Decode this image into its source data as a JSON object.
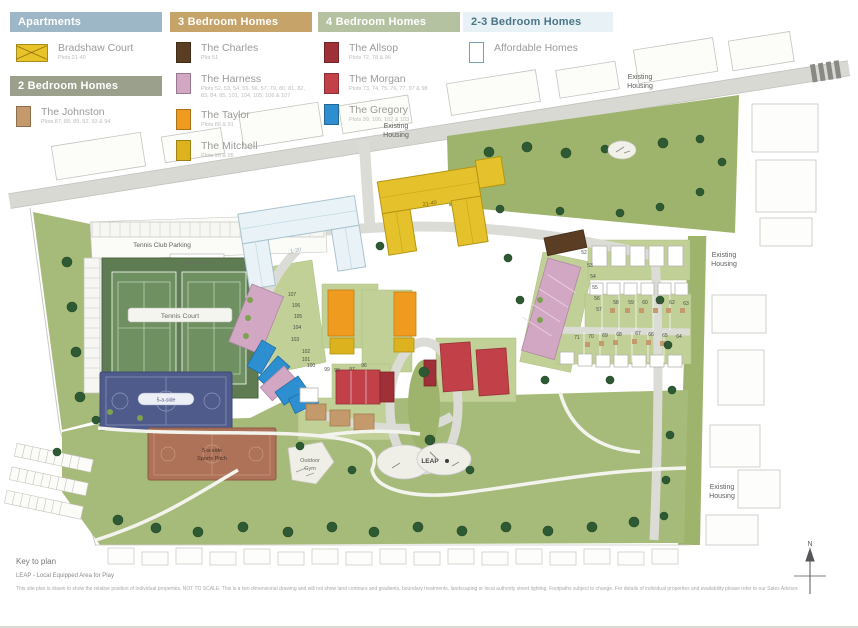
{
  "legend": {
    "apartments": {
      "header": "Apartments",
      "items": [
        {
          "name": "Bradshaw Court",
          "plots": "Plots 21-40",
          "color": "#e9c428"
        }
      ]
    },
    "two_bed": {
      "header": "2 Bedroom Homes",
      "items": [
        {
          "name": "The Johnston",
          "plots": "Plots 87, 88, 89, 92, 93 & 94",
          "color": "#c49a6c"
        }
      ]
    },
    "three_bed": {
      "header": "3 Bedroom Homes",
      "items": [
        {
          "name": "The Charles",
          "plots": "Plot 51",
          "color": "#5a3d22"
        },
        {
          "name": "The Harness",
          "plots": "Plots 52, 53, 54, 55, 56, 57, 79, 80, 81, 82, 83, 84, 85, 101, 104, 105, 106 & 107",
          "color": "#d2a7c3"
        },
        {
          "name": "The Taylor",
          "plots": "Plots 86 & 91",
          "color": "#ef9b20"
        },
        {
          "name": "The Mitchell",
          "plots": "Plots 90 & 95",
          "color": "#dcb31e"
        }
      ]
    },
    "four_bed": {
      "header": "4 Bedroom Homes",
      "items": [
        {
          "name": "The Allsop",
          "plots": "Plots 72, 78 & 96",
          "color": "#a03038"
        },
        {
          "name": "The Morgan",
          "plots": "Plots 73, 74, 75, 76, 77, 97 & 98",
          "color": "#c24048"
        },
        {
          "name": "The Gregory",
          "plots": "Plots 99, 100, 102 & 103",
          "color": "#2e8fd0"
        }
      ]
    },
    "two_three_bed": {
      "header": "2-3 Bedroom Homes",
      "items": [
        {
          "name": "Affordable Homes",
          "plots": "",
          "color": "#ffffff"
        }
      ]
    }
  },
  "map": {
    "labels": {
      "existing": "Existing",
      "housing": "Housing",
      "tennis_club_parking": "Tennis Club Parking",
      "spectator_area": "Spectator Area",
      "tennis_court": "Tennis Court",
      "five_a_side": "5-a-side",
      "pitch_line1": "5-a-side",
      "pitch_line2": "Sports Pitch",
      "outdoor": "Outdoor",
      "gym": "Gym",
      "leap": "LEAP",
      "apartments_1_20": "1-20",
      "apartments_21_40": "21-40",
      "north": "N"
    },
    "plot_numbers": [
      {
        "t": "51",
        "x": 582,
        "y": 243
      },
      {
        "t": "52",
        "x": 584,
        "y": 254
      },
      {
        "t": "53",
        "x": 590,
        "y": 267
      },
      {
        "t": "54",
        "x": 593,
        "y": 278
      },
      {
        "t": "55",
        "x": 595,
        "y": 289
      },
      {
        "t": "56",
        "x": 597,
        "y": 300
      },
      {
        "t": "57",
        "x": 599,
        "y": 311
      },
      {
        "t": "58",
        "x": 616,
        "y": 304
      },
      {
        "t": "59",
        "x": 631,
        "y": 304
      },
      {
        "t": "60",
        "x": 645,
        "y": 304
      },
      {
        "t": "61",
        "x": 659,
        "y": 304
      },
      {
        "t": "62",
        "x": 672,
        "y": 304
      },
      {
        "t": "63",
        "x": 686,
        "y": 305
      },
      {
        "t": "71",
        "x": 577,
        "y": 339
      },
      {
        "t": "70",
        "x": 591,
        "y": 338
      },
      {
        "t": "69",
        "x": 605,
        "y": 337
      },
      {
        "t": "68",
        "x": 619,
        "y": 336
      },
      {
        "t": "67",
        "x": 638,
        "y": 335
      },
      {
        "t": "66",
        "x": 651,
        "y": 336
      },
      {
        "t": "65",
        "x": 665,
        "y": 337
      },
      {
        "t": "64",
        "x": 679,
        "y": 338
      },
      {
        "t": "107",
        "x": 292,
        "y": 296
      },
      {
        "t": "106",
        "x": 296,
        "y": 307
      },
      {
        "t": "105",
        "x": 298,
        "y": 318
      },
      {
        "t": "104",
        "x": 297,
        "y": 329
      },
      {
        "t": "103",
        "x": 295,
        "y": 341
      },
      {
        "t": "102",
        "x": 306,
        "y": 353
      },
      {
        "t": "101",
        "x": 306,
        "y": 361
      },
      {
        "t": "100",
        "x": 311,
        "y": 367
      },
      {
        "t": "99",
        "x": 327,
        "y": 371
      },
      {
        "t": "98",
        "x": 337,
        "y": 372
      },
      {
        "t": "97",
        "x": 352,
        "y": 371
      },
      {
        "t": "96",
        "x": 364,
        "y": 367
      }
    ]
  },
  "footer": {
    "key_title": "Key to plan",
    "leap_note": "LEAP - Local Equipped Area for Play",
    "disclaimer": "This site plan is drawn to show the relative position of individual properties, NOT TO SCALE. This is a two dimensional drawing and will not show land contours and gradients, boundary treatments, landscaping or local authority street lighting. Footpaths subject to change. For details of individual properties and availability please refer to our Sales Advisor."
  }
}
